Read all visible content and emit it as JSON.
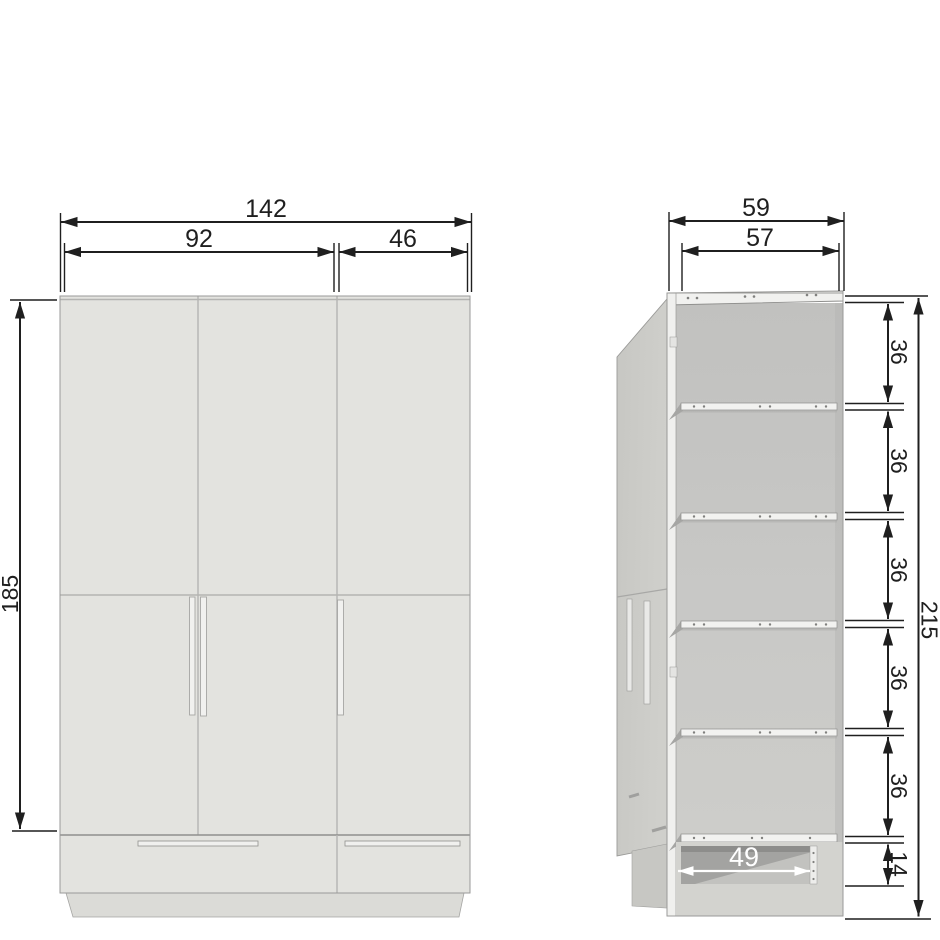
{
  "diagram": {
    "description": "Wardrobe dimension drawing, front view and open side perspective view",
    "front_view": {
      "total_width": "142",
      "left_section_width": "92",
      "right_section_width": "46",
      "door_height": "185"
    },
    "side_view": {
      "outer_depth": "59",
      "inner_depth": "57",
      "gap_labels": [
        "36",
        "36",
        "36",
        "36",
        "36"
      ],
      "total_height": "215",
      "drawer_opening_width": "49",
      "drawer_opening_height": "14"
    },
    "colors": {
      "background": "#ffffff",
      "cabinet_face": "#e3e3df",
      "side_panel": "#cbcbc7",
      "interior_back": "#c8c8c6",
      "shelf_edge": "#f2f2f0",
      "drawer_opening": "#a3a3a1",
      "plinth": "#d9d9d5",
      "dimension_line": "#1f1f1f"
    }
  }
}
